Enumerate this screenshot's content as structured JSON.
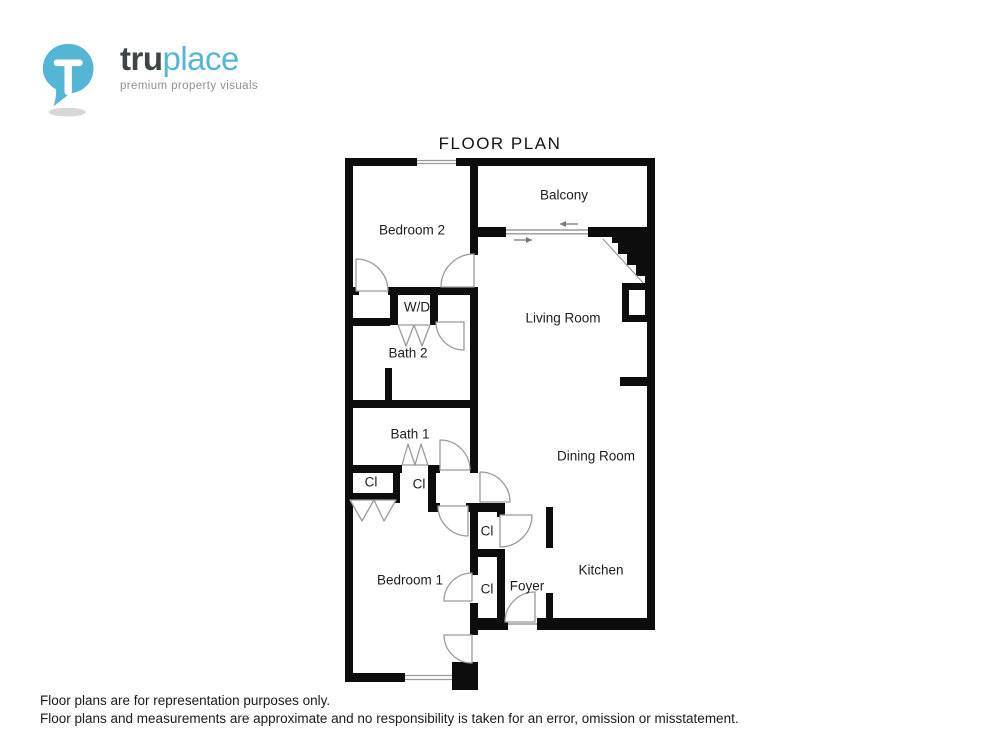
{
  "brand": {
    "name_bold": "tru",
    "name_light": "place",
    "tagline": "premium property visuals",
    "accent_color": "#55b5d5",
    "text_color": "#3f4446",
    "pin_icon": "map-pin-with-T"
  },
  "title": "FLOOR PLAN",
  "rooms": [
    {
      "label": "Balcony"
    },
    {
      "label": "Bedroom 2"
    },
    {
      "label": "W/D"
    },
    {
      "label": "Living Room"
    },
    {
      "label": "Bath 2"
    },
    {
      "label": "Bath 1"
    },
    {
      "label": "Dining Room"
    },
    {
      "label": "Cl"
    },
    {
      "label": "Cl"
    },
    {
      "label": "Cl"
    },
    {
      "label": "Bedroom 1"
    },
    {
      "label": "Cl"
    },
    {
      "label": "Foyer"
    },
    {
      "label": "Kitchen"
    }
  ],
  "footer": {
    "line1": "Floor plans are for representation purposes only.",
    "line2": "Floor plans and measurements are approximate and no responsibility is taken for an error, omission or misstatement."
  },
  "plan_colors": {
    "wall": "#0d0d0d",
    "door_swing": "#9a9a9a",
    "window": "#9a9a9a"
  }
}
